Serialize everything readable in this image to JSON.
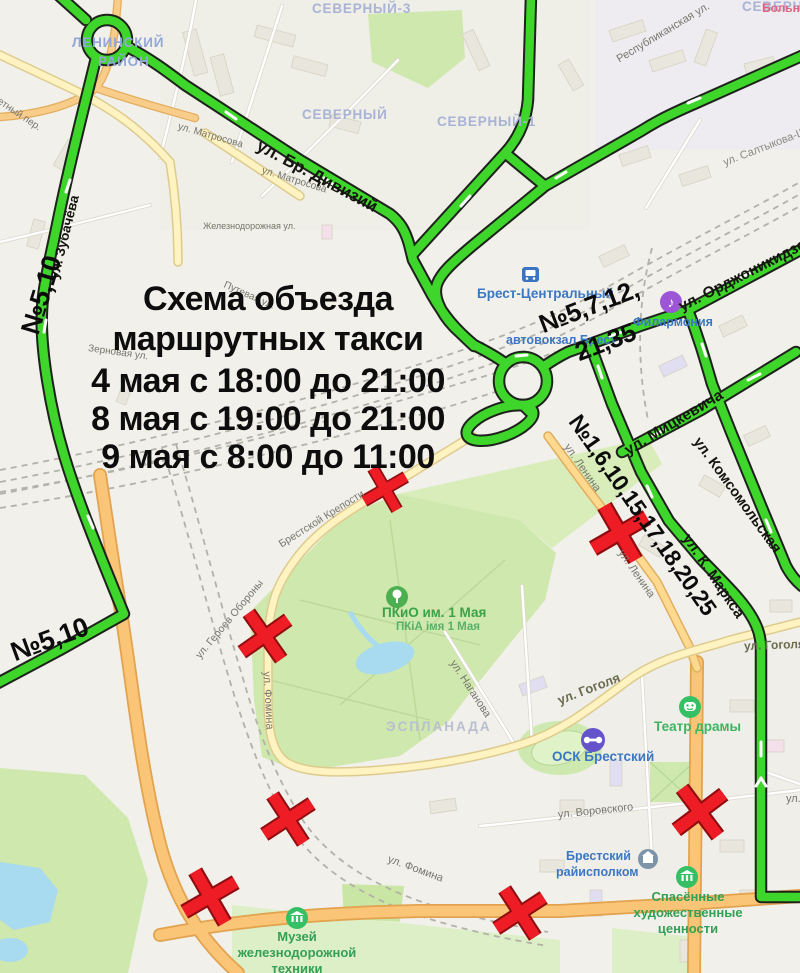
{
  "overlay": {
    "title": [
      "Схема объезда",
      "маршрутных такси",
      "4 мая с 18:00 до 21:00",
      "8 мая с 19:00 до 21:00",
      "9 мая с 8:00 до 11:00"
    ],
    "route_labels": {
      "left_top": "№5,10",
      "left_mid": "№5,10",
      "station_top": "№5,7,12,",
      "station_bottom": "21,35",
      "karl_marx": "№1,6,10,15,17,18,20,25"
    }
  },
  "districts": {
    "leninsky1": "ЛЕНИНСКИЙ",
    "leninsky2": "РАЙОН",
    "severny3": "СЕВЕРНЫЙ-3",
    "severny2": "СЕВЕРНЫЙ-2",
    "severny": "СЕВЕРНЫЙ",
    "severny1": "СЕВЕРНЫЙ-1",
    "esplanada": "ЭСПЛАНАДА"
  },
  "streets": {
    "matrosova_a": "ул. Матросова",
    "matrosova_b": "ул. Матросова",
    "br_divizij": "ул. Бр. Дивизий",
    "zheleznodorozhnaya": "Железнодорожная ул.",
    "putevaya": "Путевая ул.",
    "zernovaya": "Зерновая ул.",
    "pereulok": "етный пер.",
    "zubacheva": "ул. Зубачёва",
    "respublikanskaya": "Республиканская ул.",
    "saltykova": "ул. Салтыкова-Щ",
    "ordzhonikidze": "ул. Орджоникидзе",
    "mickevicha": "ул. Мицкевича",
    "komsomolskaya": "ул. Комсомольская",
    "k_marksa": "ул. К. Маркса",
    "lenina_a": "ул. Ленина",
    "lenina_b": "ул. Ленина",
    "geroev_a": "ул. Героев Обороны",
    "geroev_b": "Брестской Крепости",
    "fomina_a": "ул. Фомина",
    "fomina_b": "ул. Фомина",
    "naganova": "ул. Наганова",
    "gogolya_a": "ул. Гоголя",
    "gogolya_b": "ул. Гоголя",
    "vorovskogo": "ул. Воровского",
    "ul_d": "ул. Д"
  },
  "pois": {
    "brest_central": "Брест-Центральный",
    "avtovokzal": "автовокзал Брест",
    "filarmonia": "Филармония",
    "bolnitsa": "Больн",
    "pkio_ru": "ПКиО им. 1 Мая",
    "pkio_by": "ПКіА імя 1 Мая",
    "osk": "ОСК Брестский",
    "teatr": "Театр драмы",
    "raiispolkom1": "Брестский",
    "raiispolkom2": "райисполком",
    "muzei1": "Музей",
    "muzei2": "железнодорожной",
    "muzei3": "техники",
    "spasennye1": "Спасённые",
    "spasennye2": "художественные",
    "spasennye3": "ценности"
  },
  "icons": {
    "music_note": "♪"
  },
  "colors": {
    "route_green": "#3fd62b",
    "closed_x_red": "#ee1c24",
    "road_orange": "#fac576",
    "road_yellow": "#fff3c2",
    "poi_blue": "#3c77c4",
    "poi_green": "#34a055"
  }
}
